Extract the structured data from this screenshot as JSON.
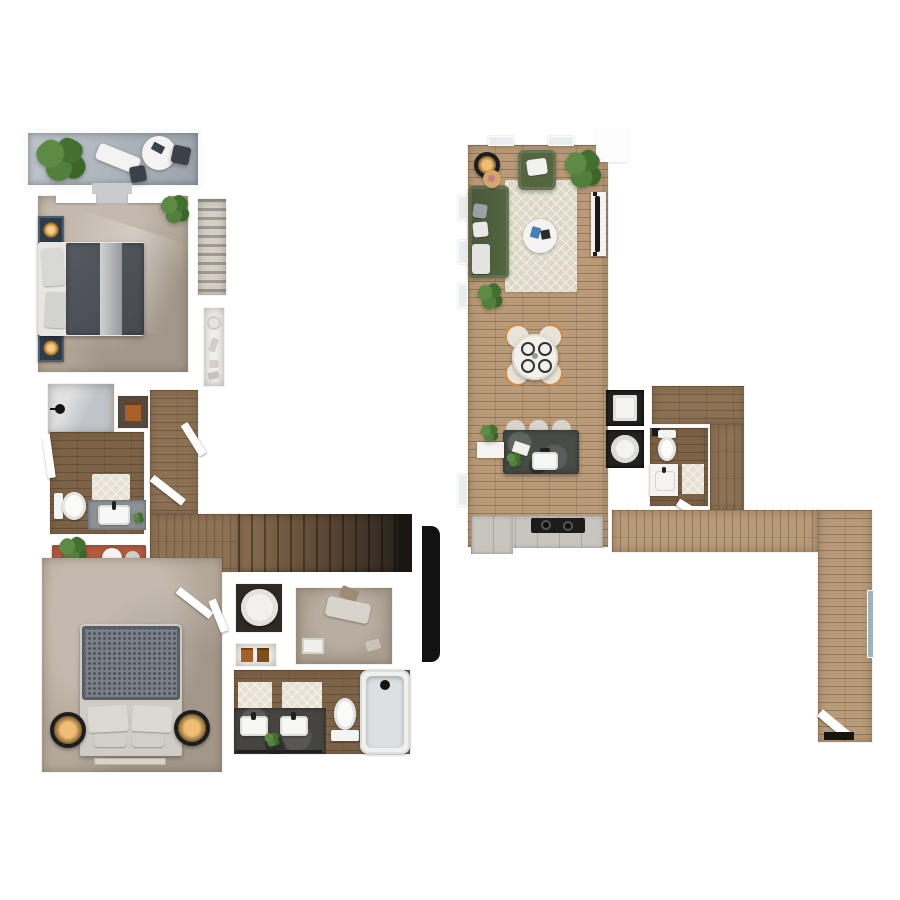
{
  "scene": {
    "type": "3d-floor-plan-rendering",
    "view": "top-down",
    "levels": [
      {
        "id": "bedroom-level",
        "position": "left",
        "rooms": [
          "balcony",
          "primary-bedroom",
          "reach-in-closet",
          "primary-bathroom",
          "hallway",
          "staircase",
          "second-bedroom",
          "linen-closet",
          "walk-in-closet",
          "second-bathroom"
        ]
      },
      {
        "id": "living-level",
        "position": "right",
        "rooms": [
          "living-room",
          "dining-area",
          "kitchen",
          "laundry-closet",
          "powder-room",
          "entry-hallway"
        ]
      }
    ]
  },
  "furniture": {
    "balcony": [
      "potted-plant",
      "lounge-chair",
      "patio-table",
      "patio-chairs"
    ],
    "primary-bedroom": [
      "double-bed",
      "nightstands",
      "table-lamps",
      "potted-plant",
      "windows",
      "curtain"
    ],
    "reach-in-closet": [
      "hanging-clothes",
      "shelf-items"
    ],
    "primary-bathroom": [
      "walk-in-shower",
      "shower-head",
      "linen-niche",
      "toilet",
      "vanity-sink",
      "bath-mat",
      "door"
    ],
    "hallway": [
      "console-table",
      "plant",
      "stools",
      "doors"
    ],
    "staircase": [
      "landing",
      "treads",
      "stair-void-marker"
    ],
    "second-bedroom": [
      "double-bed",
      "round-lamps",
      "bed-runner",
      "double-door"
    ],
    "linen-closet": [
      "laundry-hamper",
      "storage-boxes"
    ],
    "walk-in-closet": [
      "storage-bin",
      "clothes-pile",
      "basket"
    ],
    "second-bathroom": [
      "double-vanity",
      "two-sinks",
      "bath-mats",
      "toilet",
      "bathtub",
      "towel-bar",
      "plant"
    ],
    "living-room": [
      "sectional-sofa",
      "armchair",
      "area-rug",
      "coffee-table",
      "floor-lamp",
      "side-table",
      "plants",
      "tv-console",
      "tv"
    ],
    "dining-area": [
      "round-table",
      "four-chairs",
      "place-settings"
    ],
    "kitchen": [
      "island",
      "island-sink",
      "bar-stools",
      "counter",
      "cooktop",
      "side-counter",
      "plants"
    ],
    "laundry-closet": [
      "washer",
      "dryer"
    ],
    "powder-room": [
      "toilet",
      "vanity-sink",
      "rug",
      "door"
    ],
    "entry-hallway": [
      "wall-mirror",
      "entry-door",
      "threshold"
    ]
  },
  "colors": {
    "bg": "#ffffff",
    "carpet": "#b4a89a",
    "carpet-light": "#ab9f90",
    "wood-dark": "#7d6347",
    "wood-mid": "#8d7254",
    "wood-light": "#b99b79",
    "balcony-floor": "#a9b2ba",
    "rug-cream": "#ded8c6",
    "mat-cream": "#e7e1d3",
    "sofa-green": "#546540",
    "terracotta": "#b25b41",
    "navy": "#2c3a4a",
    "lamp-warm": "#e8b269",
    "duvet-dark": "#555a60",
    "duvet-gray": "#7a8087",
    "pillow": "#dcd9d3",
    "island": "#474c47",
    "vanity-dark": "#45443f",
    "counter-light": "#c8c5bf",
    "cooktop": "#1c1c1a",
    "black": "#121212",
    "white-furn": "#f4f3f1",
    "glass": "#b9bdc2",
    "steel-blue": "#9fb2bd",
    "tv": "#181818",
    "stair-light": "#8a6e50",
    "stair-dark": "#2b251d",
    "crate": "#a85f28"
  }
}
